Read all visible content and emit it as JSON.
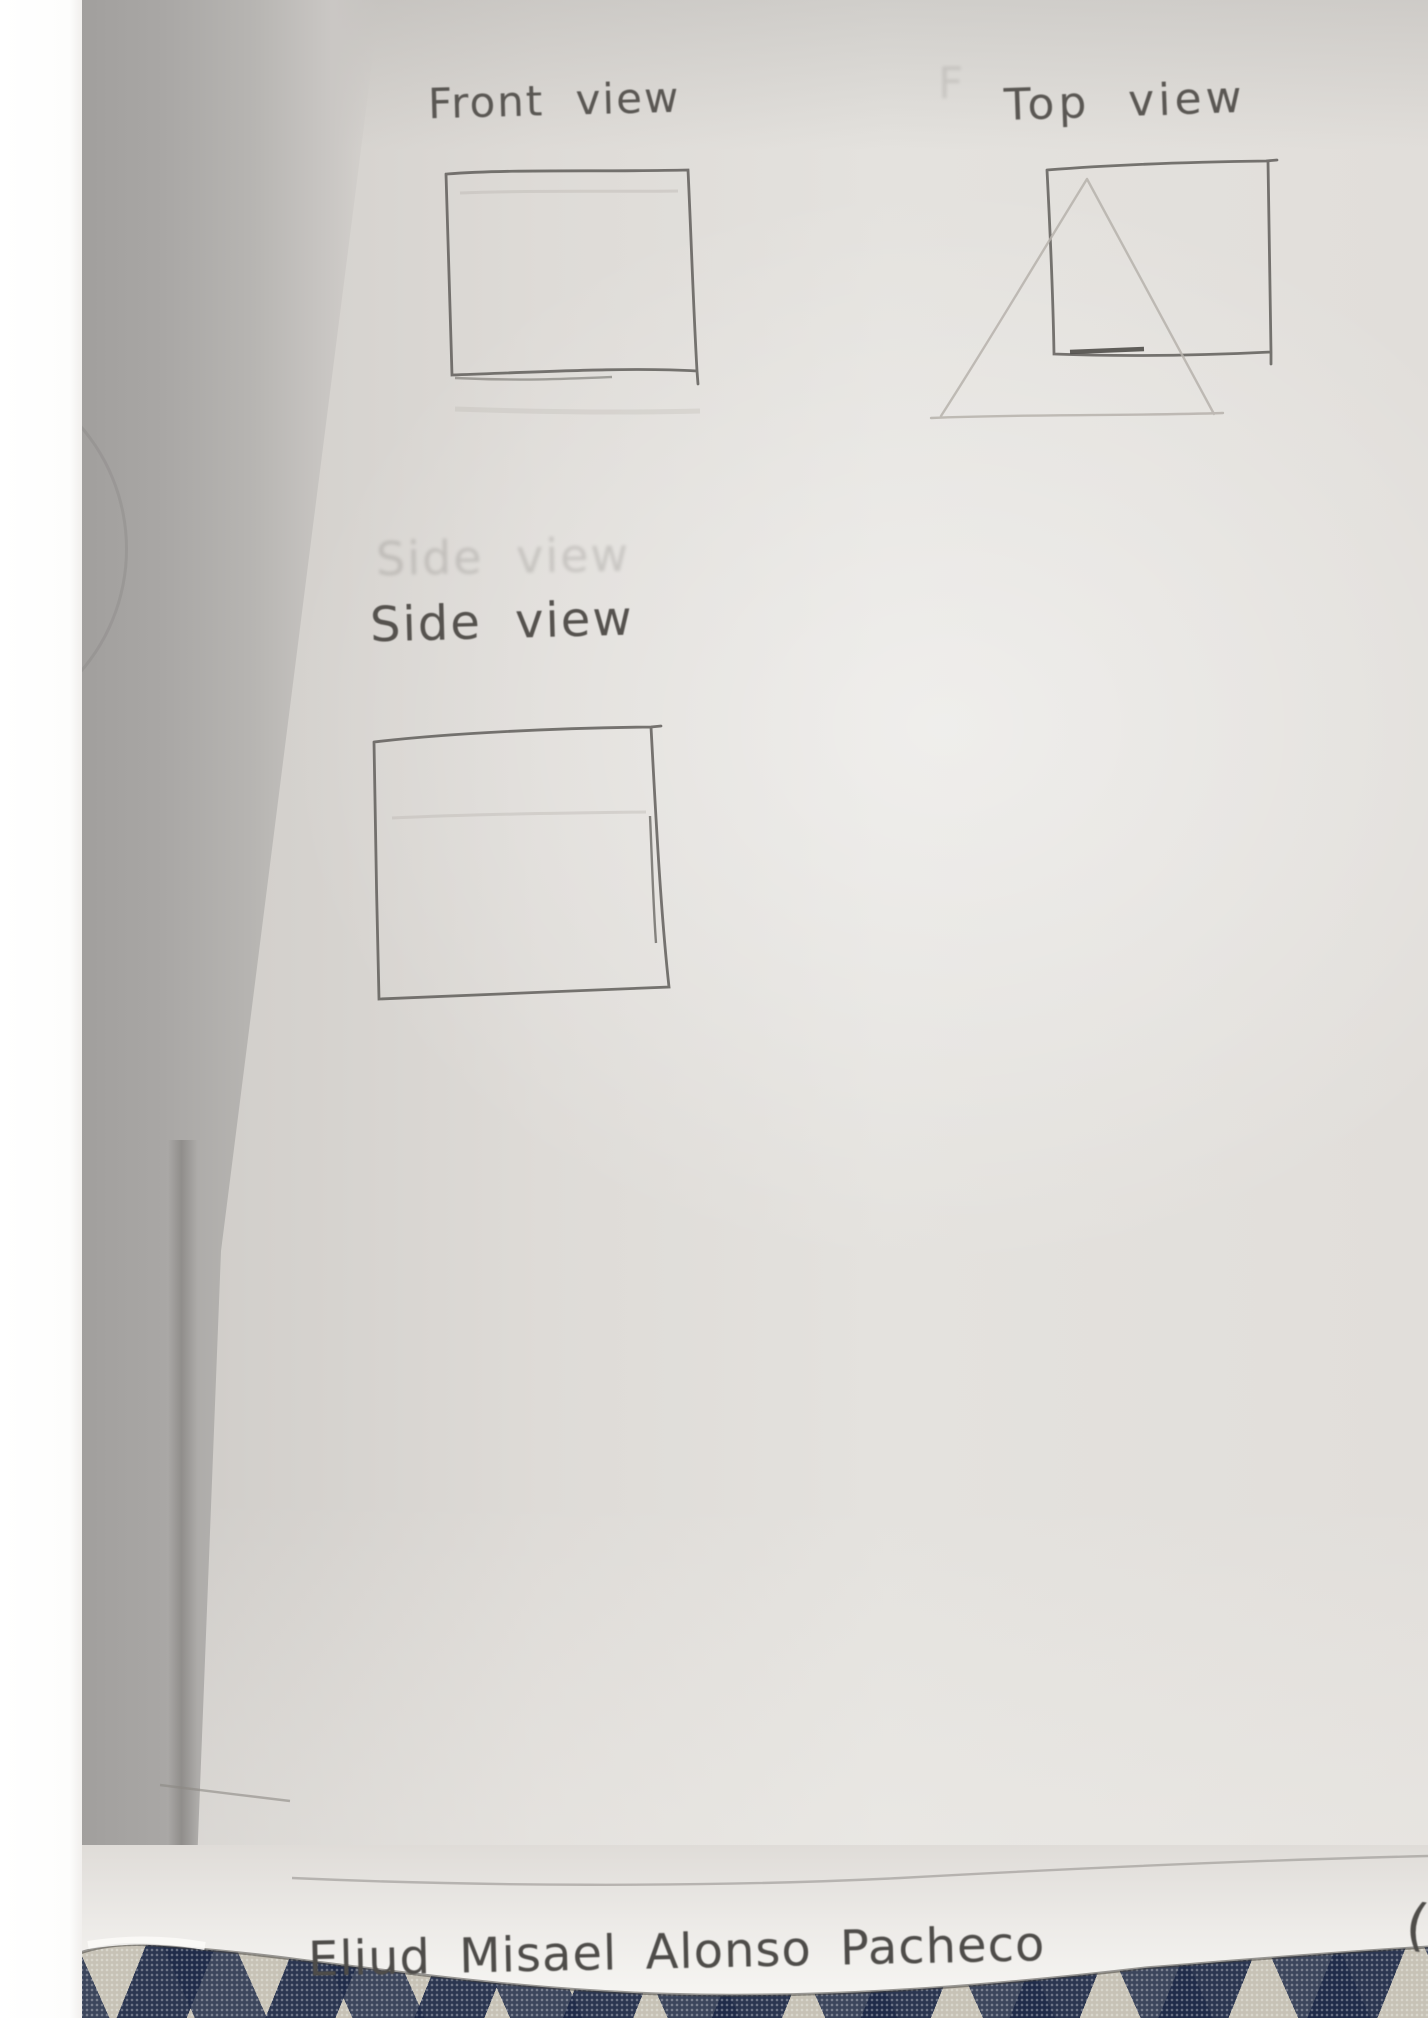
{
  "views": {
    "front": {
      "label": "Front view",
      "shape": "square"
    },
    "top": {
      "label": "Top view",
      "shapes": [
        "square",
        "faint-triangle"
      ]
    },
    "side": {
      "label": "Side view",
      "shape": "square"
    }
  },
  "ghosts": {
    "side_bleed_through": "Side view",
    "front_bleed_through": "F",
    "paren_mark": "("
  },
  "signature": "Eliud Misael Alonso Pacheco",
  "colors": {
    "pencil": "#5d5a56",
    "pencil_faint": "#b6b2ac",
    "paper": "#e4e2de",
    "paper_bottom_strip": "#f5f4f1",
    "left_shadow": "#a19f9d",
    "fabric_navy": "#243250",
    "fabric_base": "#c7c2b6"
  }
}
